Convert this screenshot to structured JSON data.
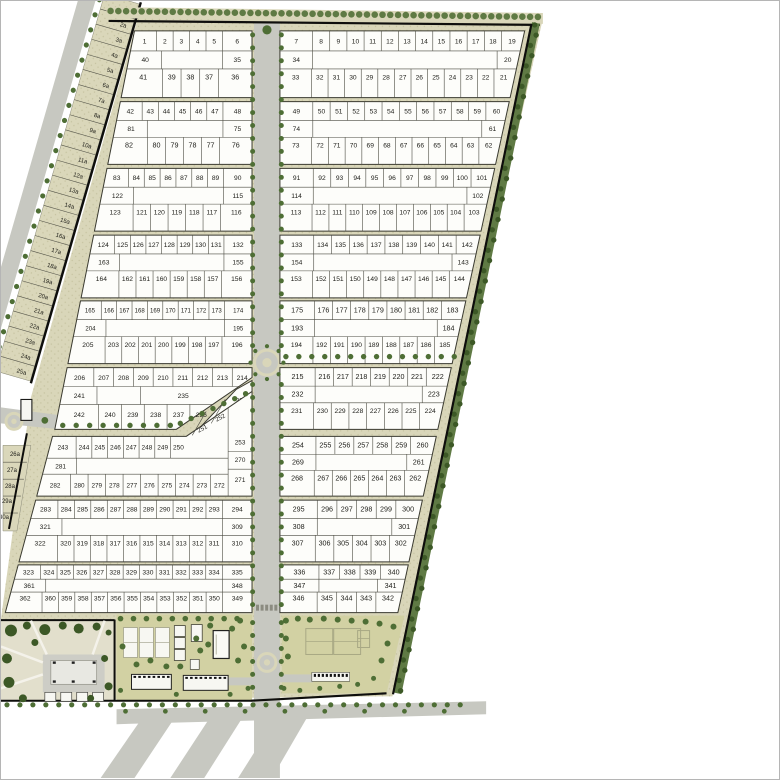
{
  "plan": {
    "colors": {
      "bg": "#ffffff",
      "verge": "#d9d6b9",
      "speck": "#c5c2a0",
      "road": "#c7c8c1",
      "block": "#fdfdfa",
      "line": "#3a3a30",
      "cell": "#4a4a40",
      "text": "#1d1d18",
      "tree": "#4e6e35",
      "treeDark": "#3c5826",
      "bndGreen": "#5f7a44",
      "black": "#0e0e0c",
      "lawn": "#d2d1a3",
      "park": "#e2dfcc",
      "plaza": "#cdcdc6",
      "court": "#a8a884",
      "white": "#f7f7f2",
      "bldgLine": "#222220"
    },
    "blocks": [
      {
        "id": "L1",
        "side": "L",
        "row": 0,
        "top": [
          "1",
          "2",
          "3",
          "4",
          "5",
          "6"
        ],
        "mid_left": "40",
        "mid_right": "35",
        "bottom": [
          "41",
          "39",
          "38",
          "37",
          "36"
        ]
      },
      {
        "id": "L2",
        "side": "L",
        "row": 1,
        "top": [
          "42",
          "43",
          "44",
          "45",
          "46",
          "47",
          "48"
        ],
        "mid_left": "81",
        "mid_right": "75",
        "bottom": [
          "82",
          "80",
          "79",
          "78",
          "77",
          "76"
        ]
      },
      {
        "id": "L3",
        "side": "L",
        "row": 2,
        "top": [
          "83",
          "84",
          "85",
          "86",
          "87",
          "88",
          "89",
          "90"
        ],
        "mid_left": "122",
        "mid_right": "115",
        "bottom": [
          "123",
          "121",
          "120",
          "119",
          "118",
          "117",
          "116"
        ]
      },
      {
        "id": "L4",
        "side": "L",
        "row": 3,
        "top": [
          "124",
          "125",
          "126",
          "127",
          "128",
          "129",
          "130",
          "131",
          "132"
        ],
        "mid_left": "163",
        "mid_right": "155",
        "bottom": [
          "164",
          "162",
          "161",
          "160",
          "159",
          "158",
          "157",
          "156"
        ]
      },
      {
        "id": "L5",
        "side": "L",
        "row": 4,
        "top": [
          "165",
          "166",
          "167",
          "168",
          "169",
          "170",
          "171",
          "172",
          "173",
          "174"
        ],
        "mid_left": "204",
        "mid_right": "195",
        "bottom": [
          "205",
          "203",
          "202",
          "201",
          "200",
          "199",
          "198",
          "197",
          "196"
        ]
      },
      {
        "id": "L8",
        "side": "L",
        "row": 7,
        "top": [
          "283",
          "284",
          "285",
          "286",
          "287",
          "288",
          "289",
          "290",
          "291",
          "292",
          "293",
          "294"
        ],
        "mid_left": "321",
        "mid_right": "309",
        "bottom": [
          "322",
          "320",
          "319",
          "318",
          "317",
          "316",
          "315",
          "314",
          "313",
          "312",
          "311",
          "310"
        ]
      },
      {
        "id": "L9",
        "side": "L",
        "row": 8,
        "top": [
          "323",
          "324",
          "325",
          "326",
          "327",
          "328",
          "329",
          "330",
          "331",
          "332",
          "333",
          "334",
          "335"
        ],
        "mid_left": "361",
        "mid_right": "348",
        "bottom": [
          "362",
          "360",
          "359",
          "358",
          "357",
          "356",
          "355",
          "354",
          "353",
          "352",
          "351",
          "350",
          "349"
        ]
      },
      {
        "id": "R1",
        "side": "R",
        "row": 0,
        "top": [
          "7",
          "8",
          "9",
          "10",
          "11",
          "12",
          "13",
          "14",
          "15",
          "16",
          "17",
          "18",
          "19"
        ],
        "mid_left": "34",
        "mid_right": "20",
        "bottom": [
          "33",
          "32",
          "31",
          "30",
          "29",
          "28",
          "27",
          "26",
          "25",
          "24",
          "23",
          "22",
          "21"
        ]
      },
      {
        "id": "R2",
        "side": "R",
        "row": 1,
        "top": [
          "49",
          "50",
          "51",
          "52",
          "53",
          "54",
          "55",
          "56",
          "57",
          "58",
          "59",
          "60"
        ],
        "mid_left": "74",
        "mid_right": "61",
        "bottom": [
          "73",
          "72",
          "71",
          "70",
          "69",
          "68",
          "67",
          "66",
          "65",
          "64",
          "63",
          "62"
        ]
      },
      {
        "id": "R3",
        "side": "R",
        "row": 2,
        "top": [
          "91",
          "92",
          "93",
          "94",
          "95",
          "96",
          "97",
          "98",
          "99",
          "100",
          "101"
        ],
        "mid_left": "114",
        "mid_right": "102",
        "bottom": [
          "113",
          "112",
          "111",
          "110",
          "109",
          "108",
          "107",
          "106",
          "105",
          "104",
          "103"
        ]
      },
      {
        "id": "R4",
        "side": "R",
        "row": 3,
        "top": [
          "133",
          "134",
          "135",
          "136",
          "137",
          "138",
          "139",
          "140",
          "141",
          "142"
        ],
        "mid_left": "154",
        "mid_right": "143",
        "bottom": [
          "153",
          "152",
          "151",
          "150",
          "149",
          "148",
          "147",
          "146",
          "145",
          "144"
        ]
      },
      {
        "id": "R5",
        "side": "R",
        "row": 4,
        "top": [
          "175",
          "176",
          "177",
          "178",
          "179",
          "180",
          "181",
          "182",
          "183"
        ],
        "mid_left": "193",
        "mid_right": "184",
        "bottom": [
          "194",
          "192",
          "191",
          "190",
          "189",
          "188",
          "187",
          "186",
          "185"
        ]
      },
      {
        "id": "R6",
        "side": "R",
        "row": 5,
        "top": [
          "215",
          "216",
          "217",
          "218",
          "219",
          "220",
          "221",
          "222"
        ],
        "mid_left": "232",
        "mid_right": "223",
        "bottom": [
          "231",
          "230",
          "229",
          "228",
          "227",
          "226",
          "225",
          "224"
        ]
      },
      {
        "id": "R7",
        "side": "R",
        "row": 6,
        "top": [
          "254",
          "255",
          "256",
          "257",
          "258",
          "259",
          "260"
        ],
        "mid_left": "269",
        "mid_right": "261",
        "bottom": [
          "268",
          "267",
          "266",
          "265",
          "264",
          "263",
          "262"
        ]
      },
      {
        "id": "R8",
        "side": "R",
        "row": 7,
        "top": [
          "295",
          "296",
          "297",
          "298",
          "299",
          "300"
        ],
        "mid_left": "308",
        "mid_right": "301",
        "bottom": [
          "307",
          "306",
          "305",
          "304",
          "303",
          "302"
        ]
      },
      {
        "id": "R9",
        "side": "R",
        "row": 8,
        "top": [
          "336",
          "337",
          "338",
          "339",
          "340"
        ],
        "mid_left": "347",
        "mid_right": "341",
        "bottom": [
          "346",
          "345",
          "344",
          "343",
          "342"
        ]
      }
    ],
    "block_l6": {
      "id": "L6",
      "top": [
        "206",
        "207",
        "208",
        "209",
        "210",
        "211",
        "212",
        "213",
        "214"
      ],
      "mid_left": "241",
      "mid_wide": "235",
      "bottom": [
        "242",
        "240",
        "239",
        "238",
        "237",
        "236"
      ],
      "sliver": [
        "233",
        "234"
      ]
    },
    "block_l7": {
      "id": "L7",
      "top": [
        "243",
        "244",
        "245",
        "246",
        "247",
        "248",
        "249",
        "250"
      ],
      "diag": [
        "251",
        "252"
      ],
      "right_col": [
        "253",
        "270",
        "271"
      ],
      "mid_left": "281",
      "bottom": [
        "282",
        "280",
        "279",
        "278",
        "277",
        "276",
        "275",
        "274",
        "273",
        "272"
      ]
    },
    "service_plots": [
      "1a",
      "2a",
      "3a",
      "4a",
      "5a",
      "6a",
      "7a",
      "8a",
      "9a",
      "10a",
      "11a",
      "12a",
      "13a",
      "14a",
      "15a",
      "16a",
      "17a",
      "18a",
      "19a",
      "20a",
      "21a",
      "22a",
      "23a",
      "24a",
      "25a"
    ],
    "service_plots_lower": [
      "26a",
      "27a",
      "28a",
      "29a",
      "30a"
    ]
  }
}
